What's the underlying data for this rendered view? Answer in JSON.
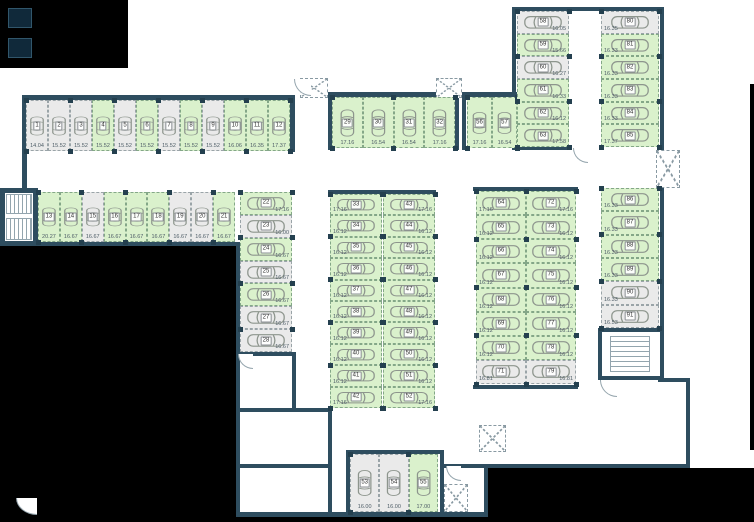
{
  "colors": {
    "available_fill": "#daf1cc",
    "available_border": "#84a788",
    "occupied_fill": "#eaeaea",
    "occupied_border": "#9aa4a8",
    "wall": "#2e4d5f",
    "outside": "#000000",
    "pillar": "#24404f",
    "car_outline": "#8d958d"
  },
  "groups": [
    {
      "id": "row-top-left",
      "dir": "h",
      "label": "bottom",
      "x": 26,
      "y": 100,
      "w": 264,
      "h": 51,
      "spaces": [
        {
          "n": "1",
          "area": "14.04",
          "status": "o"
        },
        {
          "n": "2",
          "area": "15.52",
          "status": "o"
        },
        {
          "n": "3",
          "area": "15.52",
          "status": "o"
        },
        {
          "n": "4",
          "area": "15.52",
          "status": "a"
        },
        {
          "n": "5",
          "area": "15.52",
          "status": "o"
        },
        {
          "n": "6",
          "area": "15.52",
          "status": "a"
        },
        {
          "n": "7",
          "area": "15.52",
          "status": "o"
        },
        {
          "n": "8",
          "area": "15.52",
          "status": "a"
        },
        {
          "n": "9",
          "area": "15.52",
          "status": "o"
        },
        {
          "n": "10",
          "area": "16.06",
          "status": "a"
        },
        {
          "n": "11",
          "area": "16.35",
          "status": "a"
        },
        {
          "n": "12",
          "area": "17.37",
          "status": "a"
        }
      ]
    },
    {
      "id": "row-left-second",
      "dir": "h",
      "label": "bottom",
      "x": 38,
      "y": 192,
      "w": 197,
      "h": 50,
      "spaces": [
        {
          "n": "13",
          "area": "20.27",
          "status": "a"
        },
        {
          "n": "14",
          "area": "16.67",
          "status": "a"
        },
        {
          "n": "15",
          "area": "16.67",
          "status": "o"
        },
        {
          "n": "16",
          "area": "16.67",
          "status": "a"
        },
        {
          "n": "17",
          "area": "16.67",
          "status": "a"
        },
        {
          "n": "18",
          "area": "16.67",
          "status": "a"
        },
        {
          "n": "19",
          "area": "16.67",
          "status": "o"
        },
        {
          "n": "20",
          "area": "16.67",
          "status": "o"
        },
        {
          "n": "21",
          "area": "16.67",
          "status": "a"
        }
      ]
    },
    {
      "id": "col-left-center",
      "dir": "v",
      "label": "right",
      "x": 240,
      "y": 192,
      "w": 52,
      "h": 160,
      "spaces": [
        {
          "n": "22",
          "area": "17.16",
          "status": "a"
        },
        {
          "n": "23",
          "area": "16.00",
          "status": "o"
        },
        {
          "n": "24",
          "area": "16.67",
          "status": "a"
        },
        {
          "n": "25",
          "area": "16.67",
          "status": "o"
        },
        {
          "n": "26",
          "area": "16.67",
          "status": "a"
        },
        {
          "n": "27",
          "area": "16.67",
          "status": "o"
        },
        {
          "n": "28",
          "area": "16.67",
          "status": "o"
        }
      ]
    },
    {
      "id": "row-top-middle",
      "dir": "h",
      "label": "bottom",
      "x": 332,
      "y": 97,
      "w": 123,
      "h": 51,
      "spaces": [
        {
          "n": "29",
          "area": "17.16",
          "status": "a"
        },
        {
          "n": "30",
          "area": "16.54",
          "status": "a"
        },
        {
          "n": "31",
          "area": "16.54",
          "status": "a"
        },
        {
          "n": "32",
          "area": "17.16",
          "status": "a"
        }
      ]
    },
    {
      "id": "col-middle-left",
      "dir": "v",
      "label": "left",
      "x": 330,
      "y": 194,
      "w": 52,
      "h": 214,
      "spaces": [
        {
          "n": "33",
          "area": "17.16",
          "status": "a"
        },
        {
          "n": "34",
          "area": "16.12",
          "status": "a"
        },
        {
          "n": "35",
          "area": "16.12",
          "status": "a"
        },
        {
          "n": "36",
          "area": "16.12",
          "status": "a"
        },
        {
          "n": "37",
          "area": "16.12",
          "status": "a"
        },
        {
          "n": "38",
          "area": "16.12",
          "status": "a"
        },
        {
          "n": "39",
          "area": "16.12",
          "status": "a"
        },
        {
          "n": "40",
          "area": "16.12",
          "status": "a"
        },
        {
          "n": "41",
          "area": "16.12",
          "status": "a"
        },
        {
          "n": "42",
          "area": "17.16",
          "status": "a"
        }
      ]
    },
    {
      "id": "col-middle-right",
      "dir": "v",
      "label": "right",
      "x": 383,
      "y": 194,
      "w": 52,
      "h": 214,
      "spaces": [
        {
          "n": "43",
          "area": "17.16",
          "status": "a"
        },
        {
          "n": "44",
          "area": "16.12",
          "status": "a"
        },
        {
          "n": "45",
          "area": "16.12",
          "status": "a"
        },
        {
          "n": "46",
          "area": "16.12",
          "status": "a"
        },
        {
          "n": "47",
          "area": "16.12",
          "status": "a"
        },
        {
          "n": "48",
          "area": "16.12",
          "status": "a"
        },
        {
          "n": "49",
          "area": "16.12",
          "status": "a"
        },
        {
          "n": "50",
          "area": "16.12",
          "status": "a"
        },
        {
          "n": "51",
          "area": "16.12",
          "status": "a"
        },
        {
          "n": "52",
          "area": "17.16",
          "status": "a"
        }
      ]
    },
    {
      "id": "row-bottom-middle",
      "dir": "h",
      "label": "bottom",
      "x": 350,
      "y": 454,
      "w": 88,
      "h": 58,
      "spaces": [
        {
          "n": "53",
          "area": "16.00",
          "status": "o"
        },
        {
          "n": "54",
          "area": "16.00",
          "status": "o"
        },
        {
          "n": "55",
          "area": "17.00",
          "status": "a"
        }
      ]
    },
    {
      "id": "pair-center-right",
      "dir": "h",
      "label": "bottom",
      "x": 467,
      "y": 97,
      "w": 50,
      "h": 51,
      "spaces": [
        {
          "n": "56",
          "area": "17.16",
          "status": "a"
        },
        {
          "n": "57",
          "area": "16.54",
          "status": "a"
        }
      ]
    },
    {
      "id": "col-topright-left",
      "dir": "v",
      "label": "right",
      "x": 517,
      "y": 11,
      "w": 52,
      "h": 136,
      "spaces": [
        {
          "n": "58",
          "area": "16.05",
          "status": "o"
        },
        {
          "n": "59",
          "area": "15.66",
          "status": "a"
        },
        {
          "n": "60",
          "area": "16.27",
          "status": "o"
        },
        {
          "n": "61",
          "area": "16.33",
          "status": "a"
        },
        {
          "n": "62",
          "area": "16.12",
          "status": "a"
        },
        {
          "n": "63",
          "area": "17.58",
          "status": "a"
        }
      ]
    },
    {
      "id": "col-rightmid-left",
      "dir": "v",
      "label": "left",
      "x": 476,
      "y": 191,
      "w": 50,
      "h": 193,
      "spaces": [
        {
          "n": "64",
          "area": "17.16",
          "status": "a"
        },
        {
          "n": "65",
          "area": "16.12",
          "status": "a"
        },
        {
          "n": "66",
          "area": "16.12",
          "status": "a"
        },
        {
          "n": "67",
          "area": "16.12",
          "status": "a"
        },
        {
          "n": "68",
          "area": "16.12",
          "status": "a"
        },
        {
          "n": "69",
          "area": "16.12",
          "status": "a"
        },
        {
          "n": "70",
          "area": "16.12",
          "status": "a"
        },
        {
          "n": "71",
          "area": "16.81",
          "status": "o"
        }
      ]
    },
    {
      "id": "col-rightmid-right",
      "dir": "v",
      "label": "right",
      "x": 526,
      "y": 191,
      "w": 50,
      "h": 193,
      "spaces": [
        {
          "n": "72",
          "area": "17.16",
          "status": "a"
        },
        {
          "n": "73",
          "area": "16.12",
          "status": "a"
        },
        {
          "n": "74",
          "area": "16.12",
          "status": "a"
        },
        {
          "n": "75",
          "area": "16.12",
          "status": "a"
        },
        {
          "n": "76",
          "area": "16.12",
          "status": "a"
        },
        {
          "n": "77",
          "area": "16.12",
          "status": "a"
        },
        {
          "n": "78",
          "area": "16.12",
          "status": "a"
        },
        {
          "n": "79",
          "area": "16.81",
          "status": "o"
        }
      ]
    },
    {
      "id": "col-topright-right",
      "dir": "v",
      "label": "left",
      "x": 601,
      "y": 11,
      "w": 58,
      "h": 136,
      "spaces": [
        {
          "n": "80",
          "area": "16.35",
          "status": "o"
        },
        {
          "n": "81",
          "area": "16.33",
          "status": "a"
        },
        {
          "n": "82",
          "area": "16.33",
          "status": "a"
        },
        {
          "n": "83",
          "area": "16.33",
          "status": "a"
        },
        {
          "n": "84",
          "area": "16.33",
          "status": "a"
        },
        {
          "n": "85",
          "area": "17.37",
          "status": "a"
        }
      ]
    },
    {
      "id": "col-rightedge-lower",
      "dir": "v",
      "label": "left",
      "x": 601,
      "y": 188,
      "w": 58,
      "h": 140,
      "spaces": [
        {
          "n": "86",
          "area": "16.33",
          "status": "a"
        },
        {
          "n": "87",
          "area": "16.33",
          "status": "a"
        },
        {
          "n": "88",
          "area": "16.33",
          "status": "a"
        },
        {
          "n": "89",
          "area": "16.33",
          "status": "a"
        },
        {
          "n": "90",
          "area": "16.33",
          "status": "o"
        },
        {
          "n": "91",
          "area": "16.53",
          "status": "o"
        }
      ]
    }
  ],
  "walls": [
    [
      22,
      95,
      272,
      5
    ],
    [
      22,
      95,
      5,
      151
    ],
    [
      290,
      95,
      5,
      57
    ],
    [
      0,
      188,
      38,
      4
    ],
    [
      0,
      188,
      3,
      58
    ],
    [
      34,
      190,
      4,
      54
    ],
    [
      0,
      242,
      240,
      4
    ],
    [
      236,
      244,
      4,
      272
    ],
    [
      236,
      512,
      252,
      5
    ],
    [
      236,
      352,
      60,
      4
    ],
    [
      292,
      352,
      4,
      60
    ],
    [
      236,
      408,
      96,
      4
    ],
    [
      236,
      464,
      96,
      4
    ],
    [
      328,
      408,
      4,
      109
    ],
    [
      346,
      450,
      98,
      4
    ],
    [
      346,
      450,
      4,
      64
    ],
    [
      440,
      450,
      4,
      64
    ],
    [
      443,
      464,
      247,
      4
    ],
    [
      484,
      464,
      4,
      52
    ],
    [
      686,
      380,
      4,
      88
    ],
    [
      658,
      378,
      32,
      4
    ],
    [
      328,
      92,
      131,
      5
    ],
    [
      328,
      92,
      4,
      58
    ],
    [
      455,
      92,
      4,
      58
    ],
    [
      462,
      92,
      58,
      5
    ],
    [
      462,
      92,
      4,
      58
    ],
    [
      512,
      7,
      152,
      4
    ],
    [
      512,
      7,
      4,
      143
    ],
    [
      512,
      146,
      58,
      4
    ],
    [
      660,
      7,
      4,
      145
    ],
    [
      660,
      186,
      4,
      196
    ],
    [
      473,
      187,
      105,
      4
    ],
    [
      473,
      385,
      105,
      4
    ],
    [
      328,
      190,
      108,
      4
    ],
    [
      598,
      328,
      64,
      4
    ],
    [
      598,
      328,
      4,
      52
    ],
    [
      598,
      376,
      64,
      4
    ]
  ],
  "outside": [
    [
      0,
      0,
      128,
      68
    ],
    [
      0,
      246,
      236,
      276
    ],
    [
      488,
      468,
      266,
      54
    ],
    [
      236,
      516,
      254,
      6
    ],
    [
      750,
      84,
      4,
      366
    ]
  ],
  "shafts": [
    [
      300,
      78,
      28,
      20
    ],
    [
      436,
      78,
      26,
      20
    ],
    [
      656,
      150,
      24,
      38
    ],
    [
      479,
      425,
      27,
      27
    ],
    [
      444,
      484,
      24,
      28
    ]
  ],
  "doors": [
    [
      294,
      79,
      16,
      16
    ],
    [
      238,
      354,
      14,
      14
    ],
    [
      600,
      380,
      16,
      16
    ],
    [
      16,
      498,
      20,
      16
    ],
    [
      446,
      466,
      14,
      14
    ],
    [
      573,
      148,
      14,
      14
    ]
  ],
  "stairs": [
    {
      "x": 2,
      "y": 190,
      "w": 34,
      "h": 54,
      "t": "room"
    },
    {
      "x": 6,
      "y": 194,
      "w": 26,
      "h": 20,
      "t": "treads-v"
    },
    {
      "x": 6,
      "y": 218,
      "w": 26,
      "h": 22,
      "t": "treads-v"
    },
    {
      "x": 610,
      "y": 336,
      "w": 40,
      "h": 36,
      "t": "treads-h"
    },
    {
      "x": 8,
      "y": 8,
      "w": 24,
      "h": 20,
      "t": "box"
    },
    {
      "x": 8,
      "y": 38,
      "w": 24,
      "h": 20,
      "t": "box"
    }
  ]
}
